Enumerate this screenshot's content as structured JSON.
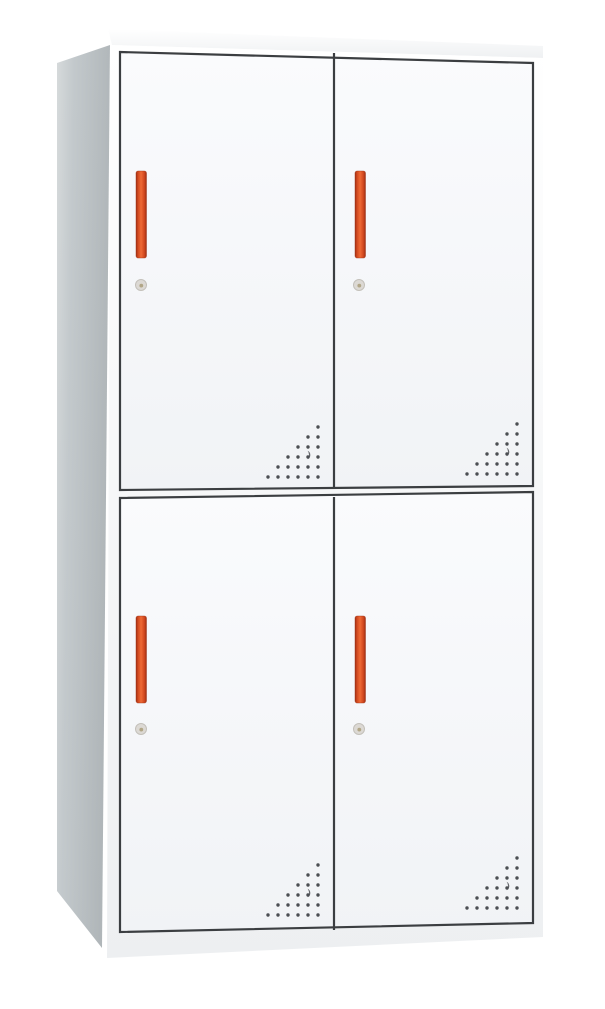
{
  "subject": "Product photo of a two-tier, four-door (2x2) steel locker cabinet with red vertical handles, keyhole locks and triangular perforated vents, on a plain white background",
  "colors": {
    "background": "#ffffff",
    "cabinet_top": "#fbfcfc",
    "side_light": "#d6dadb",
    "side_mid": "#c3c9cc",
    "side_dark": "#b0b6b9",
    "front_light": "#ffffff",
    "front_shade": "#edeff1",
    "door_light": "#fafbfd",
    "door_shade": "#f1f3f6",
    "door_frame": "#3b3e41",
    "handle_end_dark": "#9e3015",
    "handle_mid": "#d3491f",
    "handle_bright": "#ee6a35",
    "handle_edge": "#9c2f13",
    "keyhole_face": "#dcd9d4",
    "keyhole_rim": "#c3c0ba",
    "keyhole_center": "#b1a687",
    "vent_dot": "#4b4e52"
  },
  "cabinet": {
    "tiers": 2,
    "columns": 2,
    "door_count": 4,
    "handle_count": 4,
    "keyhole_count": 4,
    "vent_patch_count": 4,
    "doors": [
      {
        "position": "top-left",
        "handle": "red vertical bar",
        "lock": "keyhole below handle",
        "vents": "triangular dot perforation in bottom-right corner"
      },
      {
        "position": "top-right",
        "handle": "red vertical bar",
        "lock": "keyhole below handle",
        "vents": "triangular dot perforation in bottom-right corner"
      },
      {
        "position": "bottom-left",
        "handle": "red vertical bar",
        "lock": "keyhole below handle",
        "vents": "triangular dot perforation in bottom-right corner"
      },
      {
        "position": "bottom-right",
        "handle": "red vertical bar",
        "lock": "keyhole below handle",
        "vents": "triangular dot perforation in bottom-right corner"
      }
    ]
  },
  "vent": {
    "rows": 6,
    "spacing_px": 10,
    "dot_radius_px": 1.7
  }
}
